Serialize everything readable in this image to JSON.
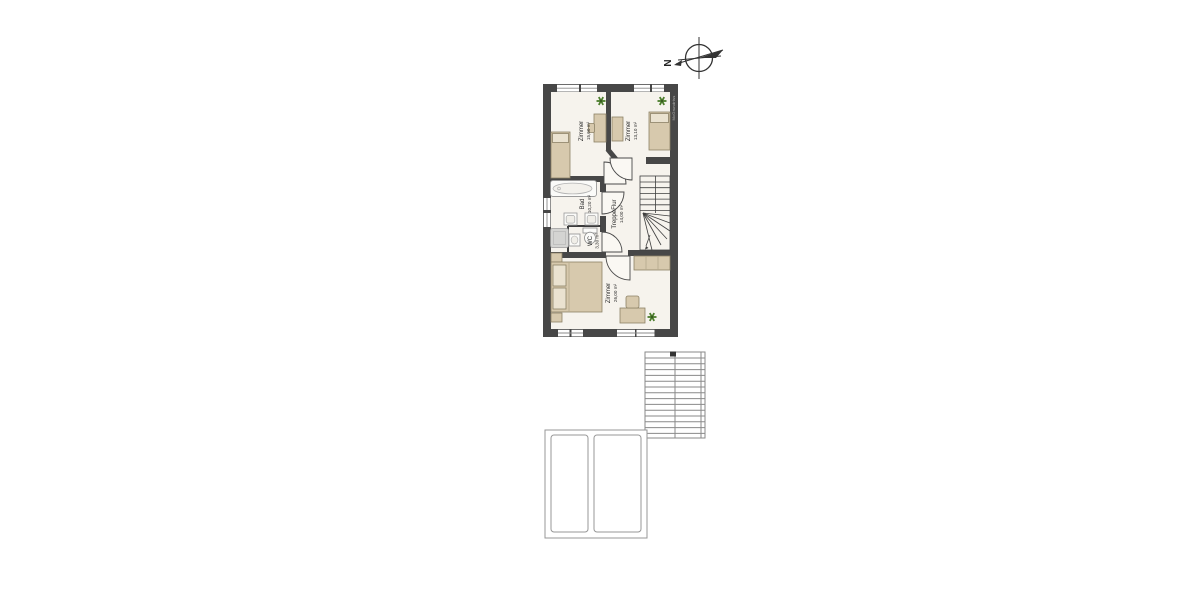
{
  "compass": {
    "label": "N"
  },
  "watermark": "McGrundriss",
  "rooms": [
    {
      "id": "zimmer-top-left",
      "name": "Zimmer",
      "area": "15,60 m²"
    },
    {
      "id": "zimmer-top-right",
      "name": "Zimmer",
      "area": "13,10 m²"
    },
    {
      "id": "bad",
      "name": "Bad",
      "area": "10,20 m²"
    },
    {
      "id": "wc",
      "name": "WC",
      "area": "3,30 m²"
    },
    {
      "id": "treppe-flur",
      "name": "TreppeFlur",
      "area": "14,00 m²"
    },
    {
      "id": "zimmer-bottom",
      "name": "Zimmer",
      "area": "26,00 m²"
    }
  ],
  "colors": {
    "wall": "#474747",
    "floor": "#f6f3ed",
    "furniture": "#d7c9ad",
    "furniture_light": "#eae2d0",
    "fixture_white": "#fbfbf9",
    "shower_gray": "#d4d4d2",
    "plant_green": "#4c7d2c",
    "outline_gray": "#8a8a8a"
  }
}
